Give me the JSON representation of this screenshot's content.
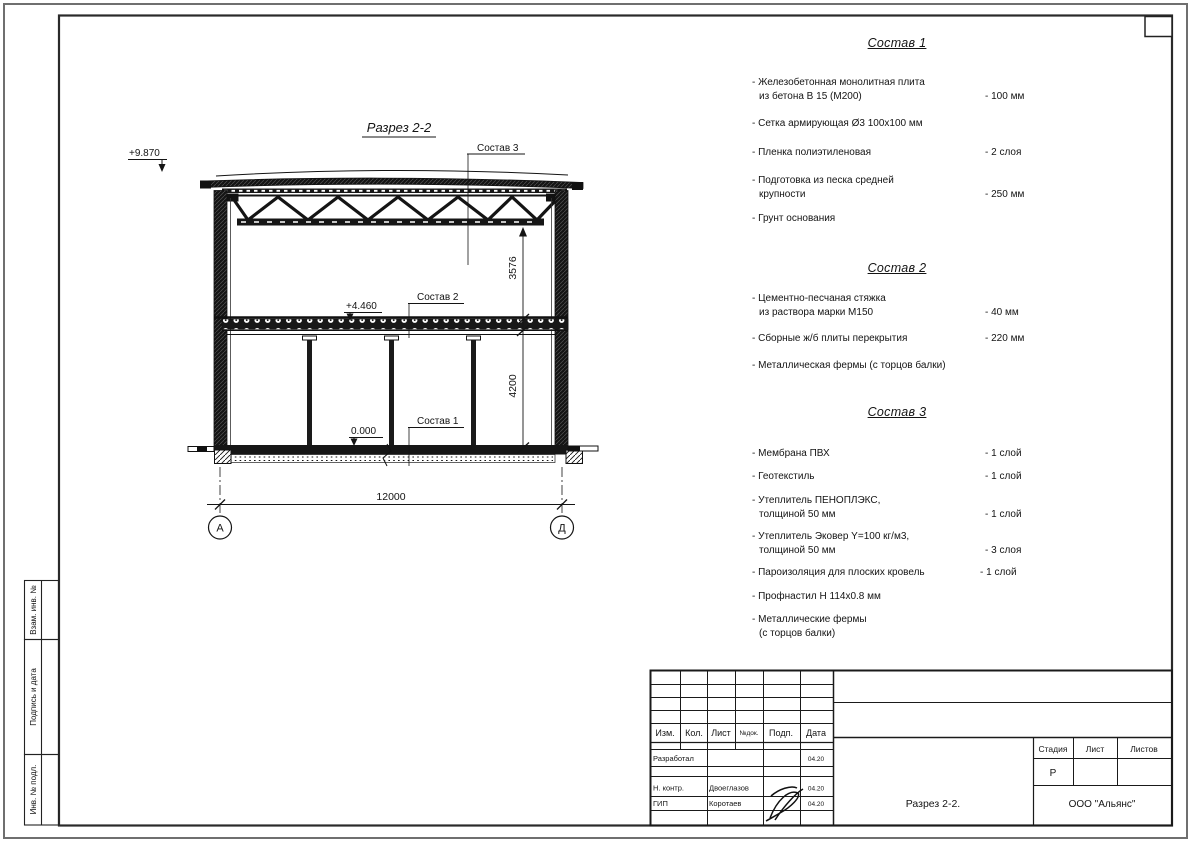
{
  "drawing": {
    "title": "Разрез 2-2",
    "elevations": {
      "roof": "+9.870",
      "floor": "+4.460",
      "ground": "0.000"
    },
    "callouts": {
      "c1": "Состав 1",
      "c2": "Состав 2",
      "c3": "Состав 3"
    },
    "dims": {
      "truss_to_floor": "3576",
      "floor_to_ground": "4200",
      "span": "12000"
    },
    "axes": {
      "left": "А",
      "right": "Д"
    }
  },
  "compositions": [
    {
      "title": "Состав 1",
      "items": [
        {
          "lines": [
            "- Железобетонная  монолитная плита",
            "из бетона В 15 (М200)"
          ],
          "value": "- 100 мм"
        },
        {
          "lines": [
            "- Сетка армирующая Ø3 100х100 мм"
          ],
          "value": ""
        },
        {
          "lines": [
            "- Пленка полиэтиленовая"
          ],
          "value": "- 2 слоя"
        },
        {
          "lines": [
            "- Подготовка из песка средней",
            "крупности"
          ],
          "value": "- 250 мм"
        },
        {
          "lines": [
            "- Грунт основания"
          ],
          "value": ""
        }
      ]
    },
    {
      "title": "Состав 2",
      "items": [
        {
          "lines": [
            "- Цементно-песчаная стяжка",
            "из раствора марки М150"
          ],
          "value": "- 40 мм"
        },
        {
          "lines": [
            "- Сборные ж/б плиты перекрытия"
          ],
          "value": "- 220 мм"
        },
        {
          "lines": [
            "- Металлическая фермы (с торцов балки)"
          ],
          "value": ""
        }
      ]
    },
    {
      "title": "Состав 3",
      "items": [
        {
          "lines": [
            "- Мембрана ПВХ"
          ],
          "value": "- 1 слой"
        },
        {
          "lines": [
            "- Геотекстиль"
          ],
          "value": "- 1 слой"
        },
        {
          "lines": [
            "- Утеплитель ПЕНОПЛЭКС,",
            "толщиной 50 мм"
          ],
          "value": "- 1 слой"
        },
        {
          "lines": [
            "- Утеплитель Эковер Y=100 кг/м3,",
            "толщиной 50 мм"
          ],
          "value": "- 3 слоя"
        },
        {
          "lines": [
            "- Пароизоляция для плоских кровель"
          ],
          "value": "- 1 слой"
        },
        {
          "lines": [
            "- Профнастил Н 114х0.8 мм"
          ],
          "value": ""
        },
        {
          "lines": [
            "- Металлические фермы",
            "(с торцов балки)"
          ],
          "value": ""
        }
      ]
    }
  ],
  "stamp": {
    "header_cols": [
      "Изм.",
      "Кол.",
      "Лист",
      "№док.",
      "Подп.",
      "Дата"
    ],
    "rows": [
      {
        "role": "Разработал",
        "name": "",
        "date": "04.20"
      },
      {
        "role": "Н. контр.",
        "name": "Двоеглазов",
        "date": "04.20"
      },
      {
        "role": "ГИП",
        "name": "Коротаев",
        "date": "04.20"
      }
    ],
    "stage_label": "Стадия",
    "sheet_label": "Лист",
    "sheets_label": "Листов",
    "stage_value": "Р",
    "doc_title": "Разрез 2-2.",
    "company": "ООО \"Альянс\""
  },
  "sidebar": {
    "labels": [
      "Взам. инв. №",
      "Подпись и дата",
      "Инв. № подл."
    ]
  }
}
